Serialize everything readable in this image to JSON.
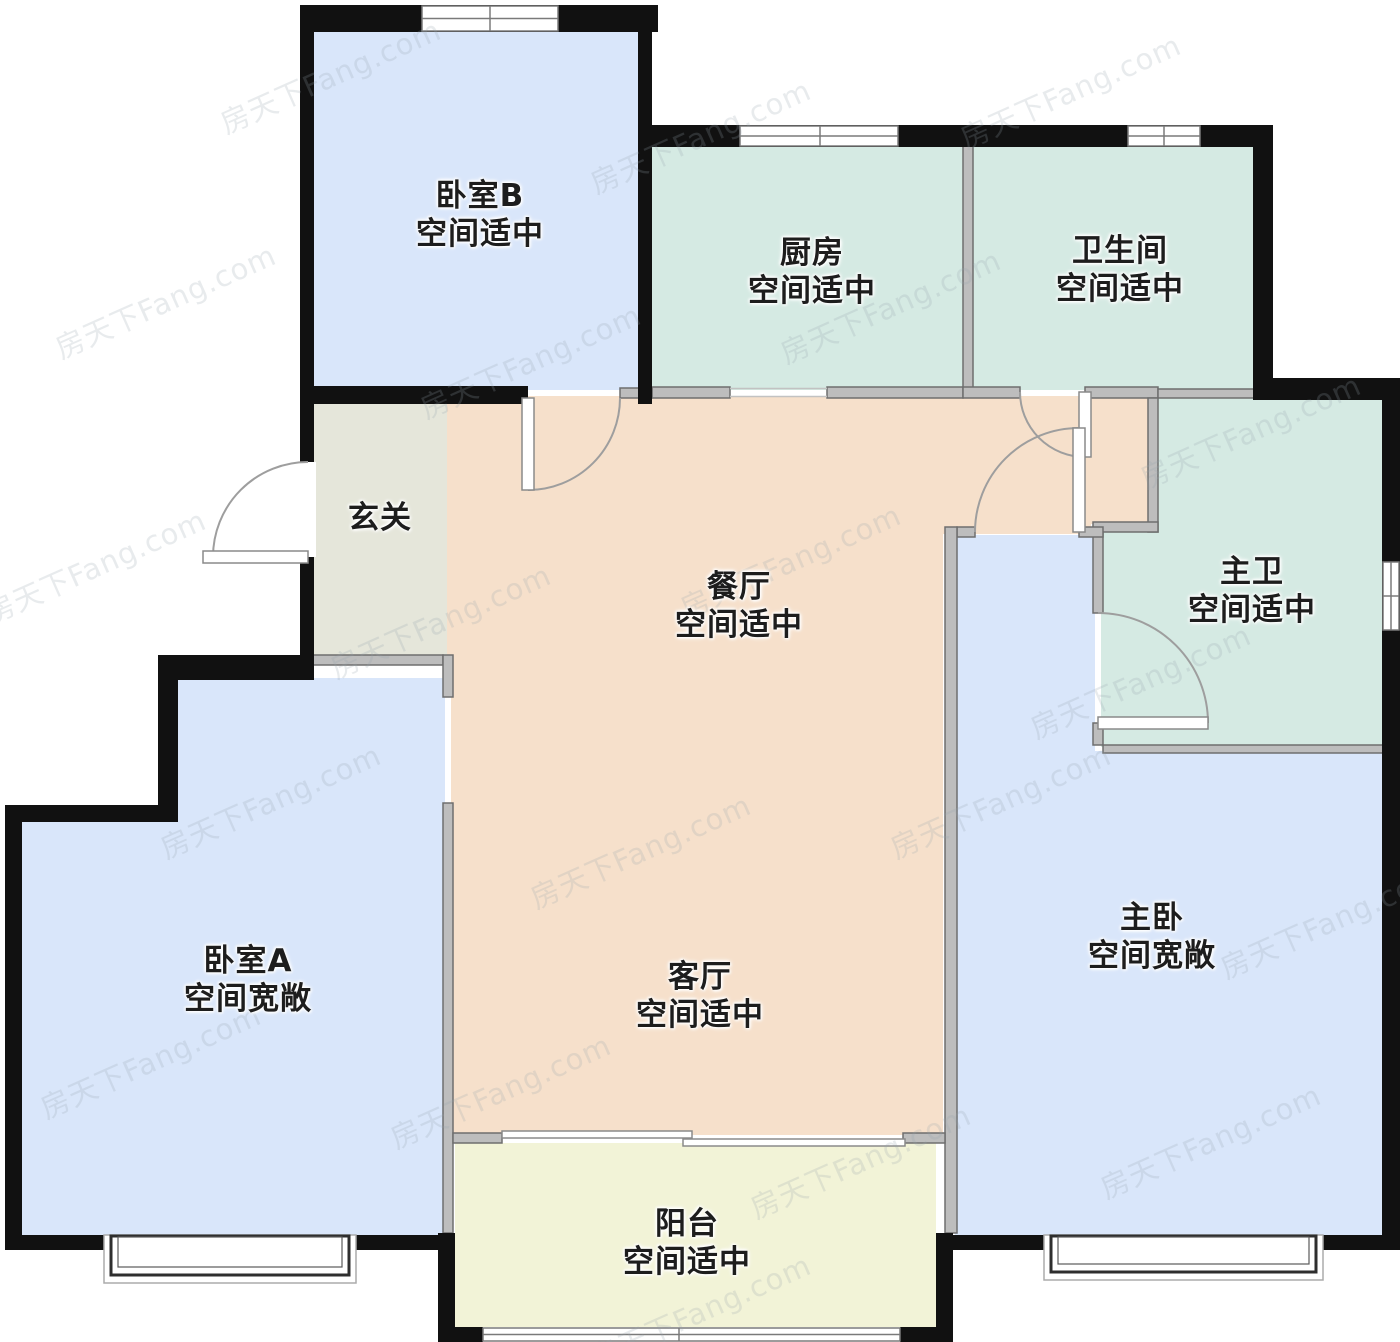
{
  "watermark": {
    "text": "房天下Fang.com"
  },
  "colors": {
    "wall_exterior": "#111111",
    "wall_interior": "#bdbdbd",
    "background": "#ffffff",
    "bedroom_fill": "#d9e6fa",
    "kitchen_bath_fill": "#d5eae3",
    "dining_living_fill": "#f6e0cb",
    "hallway_fill": "#e5e6da",
    "balcony_fill": "#f2f3d7"
  },
  "rooms": [
    {
      "id": "bedroom-b",
      "name": "卧室B",
      "status": "空间适中",
      "color": "#d9e6fa"
    },
    {
      "id": "kitchen",
      "name": "厨房",
      "status": "空间适中",
      "color": "#d5eae3"
    },
    {
      "id": "bathroom",
      "name": "卫生间",
      "status": "空间适中",
      "color": "#d5eae3"
    },
    {
      "id": "hallway",
      "name": "玄关",
      "status": "",
      "color": "#e5e6da"
    },
    {
      "id": "dining",
      "name": "餐厅",
      "status": "空间适中",
      "color": "#f6e0cb"
    },
    {
      "id": "master-bath",
      "name": "主卫",
      "status": "空间适中",
      "color": "#d5eae3"
    },
    {
      "id": "bedroom-a",
      "name": "卧室A",
      "status": "空间宽敞",
      "color": "#d9e6fa"
    },
    {
      "id": "living",
      "name": "客厅",
      "status": "空间适中",
      "color": "#f6e0cb"
    },
    {
      "id": "master-bedroom",
      "name": "主卧",
      "status": "空间宽敞",
      "color": "#d9e6fa"
    },
    {
      "id": "balcony",
      "name": "阳台",
      "status": "空间适中",
      "color": "#f2f3d7"
    }
  ]
}
